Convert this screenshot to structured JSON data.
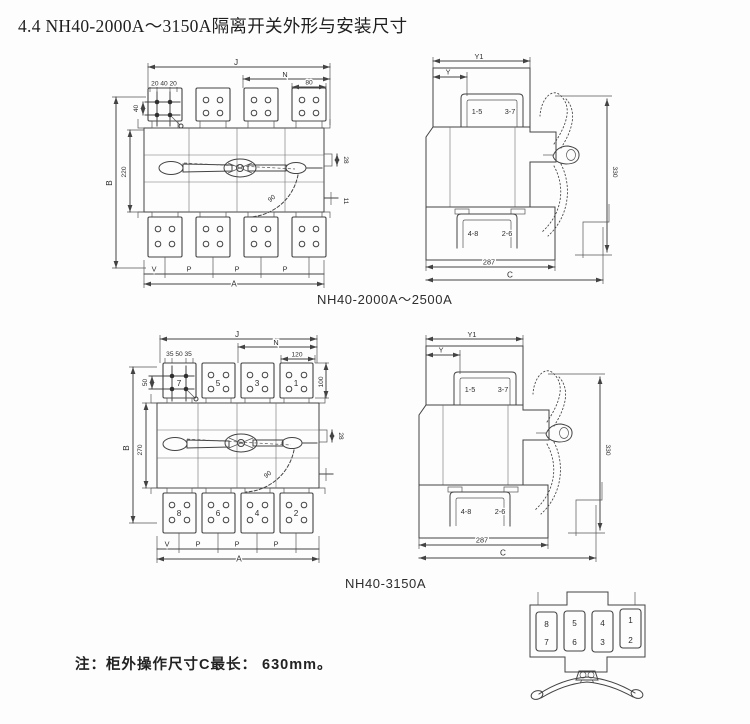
{
  "page": {
    "title": "4.4 NH40-2000A～3150A隔离开关外形与安装尺寸",
    "note": "注：柜外操作尺寸C最长： 630mm。"
  },
  "captions": {
    "model1": "NH40-2000A～2500A",
    "model2": "NH40-3150A"
  },
  "front1": {
    "dims": {
      "J": "J",
      "N": "N",
      "holes_h": "20 40 20",
      "holes_v": "40",
      "pad_w": "80",
      "B": "B",
      "inner_h": "220",
      "shaft": "28",
      "lower": "11",
      "angle": "90",
      "A": "A"
    },
    "phase_labels": [
      "V",
      "P",
      "P",
      "P"
    ]
  },
  "side1": {
    "dims": {
      "Y1": "Y1",
      "Y": "Y",
      "depth": "287",
      "C": "C",
      "handle": "330"
    },
    "terminals": {
      "top_left": "1-5",
      "top_right": "3-7",
      "bottom_left": "4-8",
      "bottom_right": "2-6"
    }
  },
  "front2": {
    "dims": {
      "J": "J",
      "N": "N",
      "holes_h": "35 50 35",
      "holes_v": "50",
      "pad_w": "120",
      "pad_h": "100",
      "B": "B",
      "inner_h": "270",
      "shaft": "28",
      "angle": "90",
      "A": "A"
    },
    "terminals_top": [
      "7",
      "5",
      "3",
      "1"
    ],
    "terminals_bottom": [
      "8",
      "6",
      "4",
      "2"
    ],
    "phase_labels": [
      "V",
      "P",
      "P",
      "P"
    ]
  },
  "side2": {
    "dims": {
      "Y1": "Y1",
      "Y": "Y",
      "depth": "287",
      "C": "C",
      "handle": "330"
    },
    "terminals": {
      "top_left": "1-5",
      "top_right": "3-7",
      "bottom_left": "4-8",
      "bottom_right": "2-6"
    }
  },
  "panel": {
    "slots_top": [
      "8",
      "5",
      "4",
      "1"
    ],
    "slots_bottom": [
      "7",
      "6",
      "3",
      "2"
    ]
  }
}
